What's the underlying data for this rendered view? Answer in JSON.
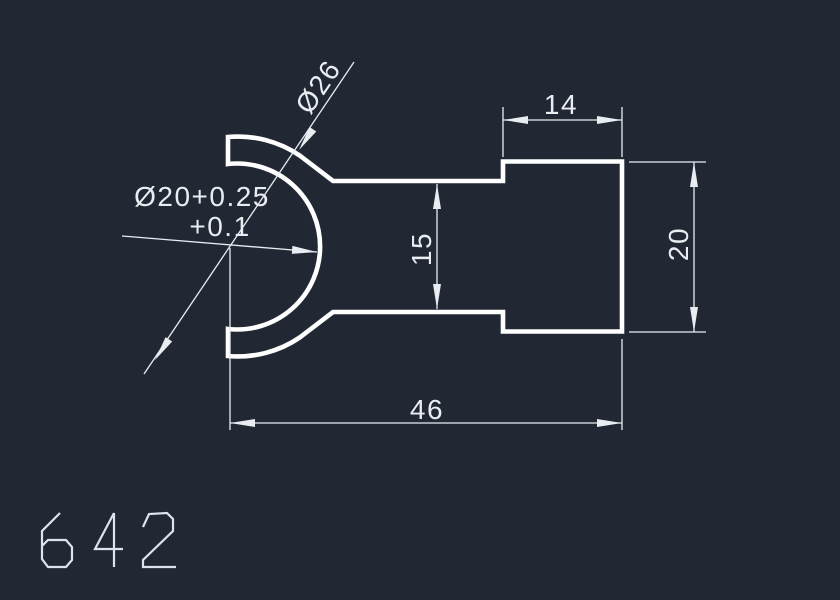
{
  "drawing": {
    "part_number": "642",
    "colors": {
      "background": "#212834",
      "geometry_line": "#ffffff",
      "dimension_line": "#e9edf2"
    },
    "dimensions": {
      "head_width": "14",
      "head_height": "20",
      "neck_height": "15",
      "total_length": "46",
      "outer_diameter": "Ø26",
      "inner_diameter": "Ø20+0.25",
      "inner_diameter_lower_tolerance": "+0.1"
    }
  }
}
